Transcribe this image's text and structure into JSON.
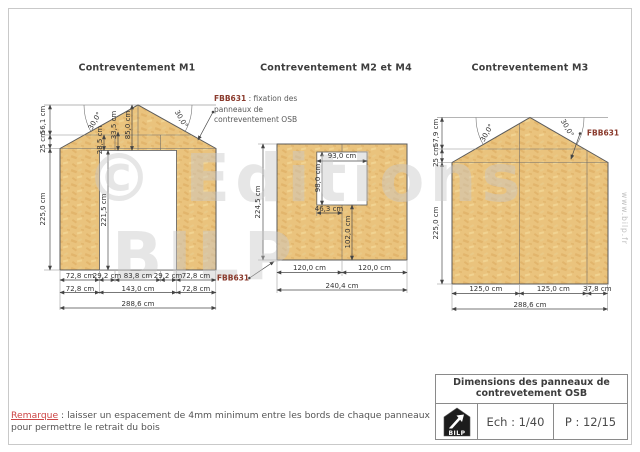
{
  "diagrams": {
    "m1": {
      "title": "Contreventement M1",
      "left_dims": [
        "56,1 cm",
        "25 cm",
        "225,0 cm"
      ],
      "angle_left": "30,0°",
      "angle_right": "30,0°",
      "header_dims": [
        "28,5 cm",
        "33,5 cm",
        "85,0 cm"
      ],
      "door_height": "221,5 cm",
      "bottom_row1": [
        "72,8 cm",
        "29,2 cm",
        "83,8 cm",
        "29,2 cm",
        "72,8 cm"
      ],
      "bottom_row2": [
        "72,8 cm",
        "143,0 cm",
        "72,8 cm"
      ],
      "bottom_total": "288,6 cm"
    },
    "m2": {
      "title": "Contreventement M2 et M4",
      "callout": {
        "code": "FBB631",
        "line1_rest": " : fixation des",
        "line2": "panneaux de",
        "line3": "contreventement OSB"
      },
      "fbb_label": "FBB631",
      "height": "224,5 cm",
      "window_width": "93,0 cm",
      "window_height": "98,0 cm",
      "window_offset_x": "46,3 cm",
      "window_offset_y": "102,0 cm",
      "bottom_row1": [
        "120,0 cm",
        "120,0 cm"
      ],
      "bottom_total": "240,4 cm"
    },
    "m3": {
      "title": "Contreventement M3",
      "fbb_label": "FBB631",
      "left_dims": [
        "57,9 cm",
        "25 cm",
        "225,0 cm"
      ],
      "angle_left": "30,0°",
      "angle_right": "30,0°",
      "bottom_row1": [
        "125,0 cm",
        "125,0 cm",
        "37,8 cm"
      ],
      "bottom_total": "288,6 cm"
    }
  },
  "watermark": {
    "line1": "© Editions",
    "line2": "BILP",
    "side": "www.bilp.fr"
  },
  "remark": {
    "label": "Remarque",
    "text": " : laisser un espacement de 4mm minimum entre les bords de chaque panneaux pour permettre le retrait du bois"
  },
  "title_block": {
    "title_line1": "Dimensions des panneaux de",
    "title_line2": "contrevetement OSB",
    "logo_text": "BILP",
    "scale": "Ech : 1/40",
    "page": "P : 12/15"
  },
  "colors": {
    "osb_fill": "#EAC37D",
    "fbb_code": "#8A3A2C",
    "remark_red": "#CC4444"
  }
}
